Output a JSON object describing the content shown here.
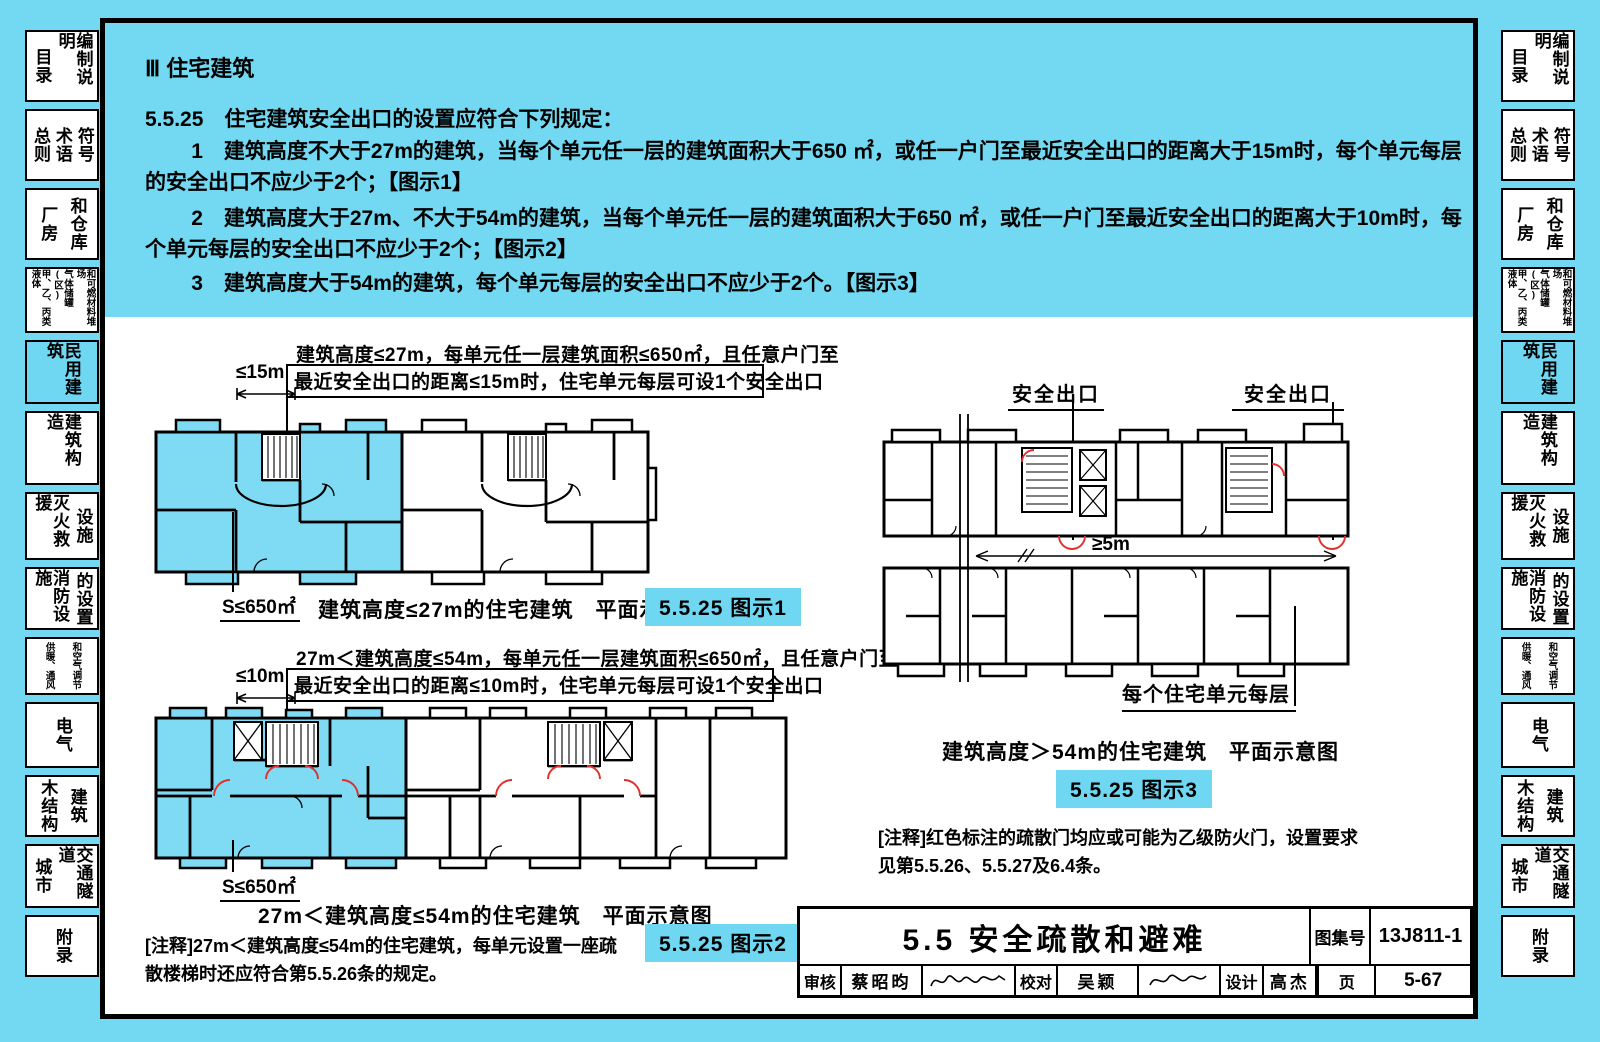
{
  "colors": {
    "cyan_bg": "#73d8f1",
    "badge_cyan": "#6fd7f2",
    "fire_door_red": "#e0302d",
    "wall_black": "#000000"
  },
  "sidebar": {
    "tabs": [
      {
        "id": "toc-notes",
        "columns": [
          "目录",
          "编制说明"
        ],
        "h": 72,
        "active": false,
        "small": false
      },
      {
        "id": "general-terms-symbols",
        "columns": [
          "总则",
          "术语",
          "符号"
        ],
        "h": 72,
        "active": false,
        "small": false
      },
      {
        "id": "factory-warehouse",
        "columns": [
          "厂房",
          "和仓库"
        ],
        "h": 72,
        "active": false,
        "small": false
      },
      {
        "id": "liquid-gas-storage",
        "columns": [
          "甲、乙、丙类液体",
          "气体储罐(区)",
          "和可燃材料堆场"
        ],
        "h": 66,
        "active": false,
        "small": true
      },
      {
        "id": "civil-buildings",
        "columns": [
          "民用建筑"
        ],
        "h": 64,
        "active": true,
        "small": false
      },
      {
        "id": "building-construction",
        "columns": [
          "建筑构造"
        ],
        "h": 74,
        "active": false,
        "small": false
      },
      {
        "id": "firefighting-rescue",
        "columns": [
          "灭火救援",
          "设施"
        ],
        "h": 68,
        "active": false,
        "small": false
      },
      {
        "id": "fire-facilities",
        "columns": [
          "消防设施",
          "的设置"
        ],
        "h": 63,
        "active": false,
        "small": false
      },
      {
        "id": "hvac",
        "columns": [
          "供暖、通风",
          "和空气调节"
        ],
        "h": 58,
        "active": false,
        "small": true
      },
      {
        "id": "electrical",
        "columns": [
          "电气"
        ],
        "h": 66,
        "active": false,
        "small": false
      },
      {
        "id": "timber-structure",
        "columns": [
          "木结构",
          "建筑"
        ],
        "h": 62,
        "active": false,
        "small": false
      },
      {
        "id": "city-traffic-tunnel",
        "columns": [
          "城市",
          "交通隧道"
        ],
        "h": 64,
        "active": false,
        "small": false
      },
      {
        "id": "appendix",
        "columns": [
          "附录"
        ],
        "h": 62,
        "active": false,
        "small": false
      }
    ]
  },
  "content": {
    "section_title": "Ⅲ 住宅建筑",
    "clause_head": "5.5.25　住宅建筑安全出口的设置应符合下列规定：",
    "clauses": [
      "1　建筑高度不大于27m的建筑，当每个单元任一层的建筑面积大于650 ㎡，或任一户门至最近安全出口的距离大于15m时，每个单元每层的安全出口不应少于2个；【图示1】",
      "2　建筑高度大于27m、不大于54m的建筑，当每个单元任一层的建筑面积大于650 ㎡，或任一户门至最近安全出口的距离大于10m时，每个单元每层的安全出口不应少于2个；【图示2】",
      "3　建筑高度大于54m的建筑，每个单元每层的安全出口不应少于2个。【图示3】"
    ],
    "fig1": {
      "ann1": "建筑高度≤27m，每单元任一层建筑面积≤650㎡，且任意户门至",
      "ann2": "最近安全出口的距离≤15m时，住宅单元每层可设1个安全出口",
      "dim": "≤15m",
      "area": "S≤650㎡",
      "caption": "建筑高度≤27m的住宅建筑　平面示意图",
      "badge": "5.5.25 图示1"
    },
    "fig2": {
      "ann1": "27m＜建筑高度≤54m，每单元任一层建筑面积≤650㎡，且任意户门至",
      "ann2": "最近安全出口的距离≤10m时，住宅单元每层可设1个安全出口",
      "dim": "≤10m",
      "area": "S≤650㎡",
      "caption": "27m＜建筑高度≤54m的住宅建筑　平面示意图",
      "badge": "5.5.25 图示2",
      "note": "[注释]27m＜建筑高度≤54m的住宅建筑，每单元设置一座疏散楼梯时还应符合第5.5.26条的规定。"
    },
    "fig3": {
      "exit_left": "安全出口",
      "exit_right": "安全出口",
      "dim": "≥5m",
      "unit_label": "每个住宅单元每层",
      "caption": "建筑高度＞54m的住宅建筑　平面示意图",
      "badge": "5.5.25 图示3",
      "note": "[注释]红色标注的疏散门均应或可能为乙级防火门，设置要求见第5.5.26、5.5.27及6.4条。"
    },
    "titleblock": {
      "section_title": "5.5 安全疏散和避难",
      "atlas_label": "图集号",
      "atlas_no": "13J811-1",
      "page_label": "页",
      "page_no": "5-67",
      "audit_label": "审核",
      "audit_name": "蔡昭昀",
      "check_label": "校对",
      "check_name": "吴颖",
      "design_label": "设计",
      "design_name": "高杰"
    }
  }
}
